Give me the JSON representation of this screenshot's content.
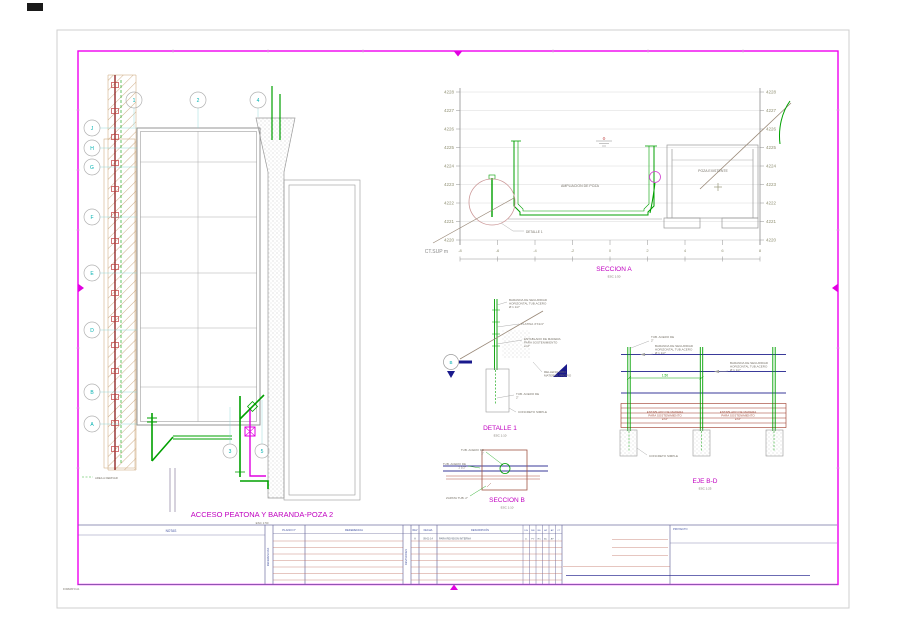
{
  "sheet": {
    "format_label": "FORMATO A1"
  },
  "plan": {
    "title": "ACCESO PEATONA Y BARANDA-POZA 2",
    "scale": "ESC 1:50",
    "col_bubbles": [
      "1",
      "2",
      "4"
    ],
    "pipe_bubbles": [
      "3",
      "5"
    ],
    "row_bubbles": [
      "J",
      "H",
      "G",
      "F",
      "E",
      "D",
      "B",
      "A"
    ],
    "area_label": "AREA A DERIVAR"
  },
  "seccion_a": {
    "title": "SECCION A",
    "scale": "ESC 1:50",
    "axis_label": "CT.SUP m",
    "elev_labels": [
      "4228",
      "4227",
      "4226",
      "4225",
      "4224",
      "4223",
      "4222",
      "4221",
      "4220"
    ],
    "x_labels": [
      "-8",
      "-6",
      "-4",
      "-2",
      "0",
      "2",
      "4",
      "6",
      "8"
    ],
    "ampliacion_label": "AMPLIACION DE POZA",
    "poza_label": "POZA EXISTENTE",
    "detalle_ref": "DETALLE 1"
  },
  "detalle_1": {
    "title": "DETALLE 1",
    "scale": "ESC 1:10",
    "marker": "B",
    "baranda": [
      "BARANDA DE SEGURIDAD",
      "HORIZONTAL TUB.ACERO",
      "Ø 1 1/2\""
    ],
    "platina": "PLATINA 4\"X1/4\"",
    "entablado": [
      "ENTABLADO DE MADERA",
      "PARA SOSTENIMIENTO",
      "e=2\""
    ],
    "relleno": [
      "RELLENO CON",
      "MATERIAL PROPIO"
    ],
    "tub2": [
      "TUB. ACERO DE",
      "2\""
    ],
    "concreto": "CONCRETO SIMPLE"
  },
  "seccion_b": {
    "title": "SECCION B",
    "scale": "ESC 1:10",
    "tub2": [
      "TUB. ACERO DE",
      "2\""
    ],
    "tub112": [
      "TUB. ACERO DE",
      "1 1/2\""
    ],
    "zapata": "ZAPATA TUB. 2\""
  },
  "eje_bd": {
    "title": "EJE B-D",
    "scale": "ESC 1:25",
    "dim": "1.50",
    "tub2": [
      "TUB. ACERO DE",
      "2\""
    ],
    "baranda1": [
      "BARANDA DE SEGURIDAD",
      "HORIZONTAL TUB.ACERO",
      "Ø 1 1/2\""
    ],
    "baranda2": [
      "BARANDA DE SEGURIDAD",
      "HORIZONTAL TUB.ACERO",
      "Ø 1 1/2\""
    ],
    "entablado1": [
      "ENTABLADO DE MADERA",
      "PARA SOSTENIMIENTO",
      "e=2\""
    ],
    "entablado2": [
      "ENTABLADO DE MADERA",
      "PARA SOSTENIMIENTO",
      "e=2\""
    ],
    "concreto": "CONCRETO SIMPLE"
  },
  "titleblock": {
    "notas": "NOTAS",
    "referencias": "REFERENCIAS",
    "plano_n": "PLANO N°",
    "referencia": "REFERENCIA",
    "revisiones": "REVISIONES",
    "rev": "REV",
    "fecha": "FECHA",
    "descripcion": "DESCRIPCIÓN",
    "small_cols": [
      "DIS",
      "DIB",
      "RE",
      "AP",
      "AP",
      "CT"
    ],
    "row1": {
      "rev": "A",
      "fecha": "09-01-14",
      "descripcion": "PARA REVISION INTERNA",
      "initials": [
        "JL",
        "PV",
        "RC",
        "AC",
        "AP",
        "-"
      ]
    },
    "proyecto": "PROYECTO"
  }
}
